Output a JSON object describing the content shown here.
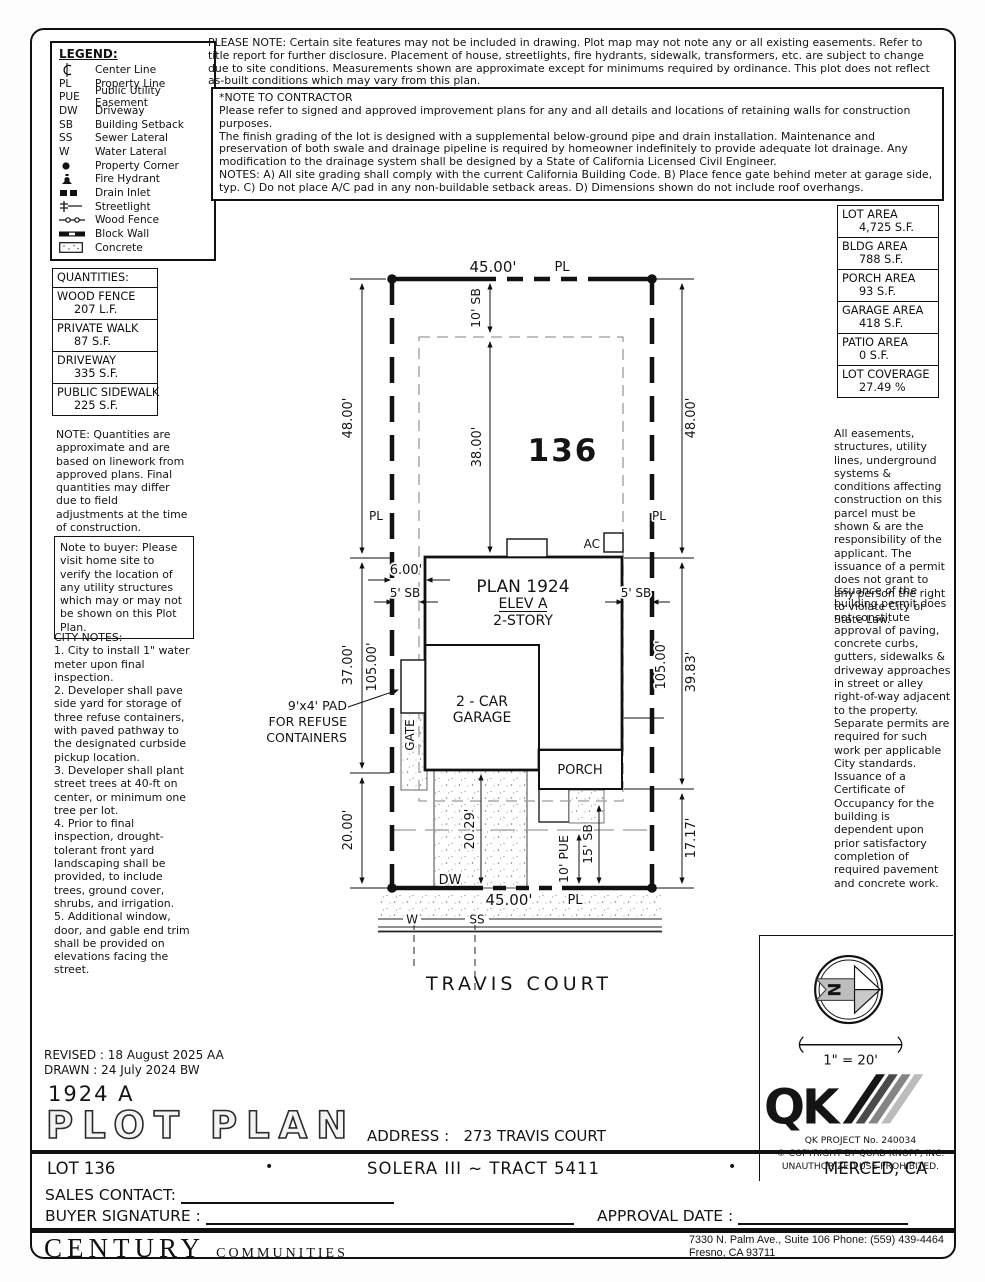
{
  "legend": {
    "title": "LEGEND:",
    "items": [
      {
        "sym": "",
        "label": "Center Line"
      },
      {
        "sym": "PL",
        "label": "Property Line"
      },
      {
        "sym": "PUE",
        "label": "Public Utility Easement"
      },
      {
        "sym": "DW",
        "label": "Driveway"
      },
      {
        "sym": "SB",
        "label": "Building Setback"
      },
      {
        "sym": "SS",
        "label": "Sewer Lateral"
      },
      {
        "sym": "W",
        "label": "Water Lateral"
      },
      {
        "sym": "",
        "label": "Property Corner"
      },
      {
        "sym": "",
        "label": "Fire Hydrant"
      },
      {
        "sym": "",
        "label": "Drain Inlet"
      },
      {
        "sym": "",
        "label": "Streetlight"
      },
      {
        "sym": "",
        "label": "Wood Fence"
      },
      {
        "sym": "",
        "label": "Block Wall"
      },
      {
        "sym": "",
        "label": "Concrete"
      }
    ]
  },
  "top_notes": {
    "please_note": "PLEASE NOTE:  Certain site features may not be included in drawing.  Plot map may not note any or all existing easements. Refer to title report for further disclosure.  Placement of house, streetlights, fire hydrants, sidewalk, transformers, etc. are subject to change due to site conditions.  Measurements shown are approximate except for minimums required by ordinance.  This plot does not reflect as-built conditions which may vary from this plan.",
    "contractor_note": "*NOTE TO CONTRACTOR\nPlease refer to signed and approved improvement plans for any and all details and locations of retaining walls for construction purposes.\nThe finish grading of the lot is designed with a supplemental below-ground pipe and drain installation.  Maintenance and preservation of both swale and drainage pipeline is required by homeowner indefinitely to provide adequate lot drainage.  Any modification to the drainage system shall be designed by a State of California Licensed Civil Engineer.\nNOTES:  A) All site grading shall comply with the current California Building Code.  B) Place fence gate behind meter at garage side, typ.  C) Do not place A/C pad in any non-buildable setback areas.  D) Dimensions shown do not include roof overhangs."
  },
  "quantities": {
    "title": "QUANTITIES:",
    "rows": [
      {
        "name": "WOOD FENCE",
        "value": "207 L.F."
      },
      {
        "name": "PRIVATE WALK",
        "value": "87 S.F."
      },
      {
        "name": "DRIVEWAY",
        "value": "335 S.F."
      },
      {
        "name": "PUBLIC SIDEWALK",
        "value": "225 S.F."
      }
    ],
    "note": "NOTE: Quantities are approximate and are based on linework from approved plans.  Final quantities may differ due to field adjustments at the time of construction."
  },
  "buyer_note": "Note to buyer: Please visit home site to verify the location of any utility structures which may or may not be shown on this Plot Plan.",
  "city_notes": "CITY NOTES:\n1. City to install 1\" water meter upon final inspection.\n2. Developer shall pave side yard for storage of three refuse containers, with paved pathway to the designated curbside pickup location.\n3. Developer shall plant street trees at 40-ft on center, or minimum one tree per lot.\n4. Prior to final inspection, drought-tolerant front yard landscaping shall be provided, to include trees, ground cover, shrubs, and irrigation.\n5. Additional window, door, and gable end trim shall be provided on elevations facing the street.",
  "areas": {
    "rows": [
      {
        "name": "LOT AREA",
        "value": "4,725 S.F."
      },
      {
        "name": "BLDG AREA",
        "value": "788 S.F."
      },
      {
        "name": "PORCH AREA",
        "value": "93 S.F."
      },
      {
        "name": "GARAGE AREA",
        "value": "418 S.F."
      },
      {
        "name": "PATIO AREA",
        "value": "0 S.F."
      },
      {
        "name": "LOT COVERAGE",
        "value": "27.49 %"
      }
    ]
  },
  "side_notes": {
    "p1": "All easements, structures, utility lines, underground systems & conditions affecting construction on this parcel must be shown & are the responsibility of the applicant. The issuance of a permit does not grant to any person the right to violate City or State Law.",
    "p2": "Issuance of the building permit does not constitute approval of paving, concrete curbs, gutters, sidewalks & driveway approaches in street or alley right-of-way adjacent to the property. Separate permits are required for such work per applicable City standards. Issuance of a Certificate of Occupancy for the building is dependent upon prior satisfactory completion of required pavement and concrete work."
  },
  "plot": {
    "labels": {
      "dim_45_top": "45.00'",
      "pl_top": "PL",
      "sb10": "10' SB",
      "dim38": "38.00'",
      "lot_number": "136",
      "dim48_left": "48.00'",
      "dim48_right": "48.00'",
      "pl_left": "PL",
      "pl_right": "PL",
      "dim6": "6.00'",
      "sb5_left": "5' SB",
      "sb5_right": "5' SB",
      "plan_name": "PLAN 1924",
      "elev": "ELEV A",
      "story": "2-STORY",
      "ac": "AC",
      "garage1": "2 - CAR",
      "garage2": "GARAGE",
      "porch": "PORCH",
      "gate": "GATE",
      "pad1": "9'x4' PAD",
      "pad2": "FOR REFUSE",
      "pad3": "CONTAINERS",
      "dim37": "37.00'",
      "dim105_left": "105.00'",
      "dim105_right": "105.00'",
      "dim3983": "39.83'",
      "dim20": "20.00'",
      "dim2029": "20.29'",
      "pue10": "10' PUE",
      "sb15": "15' SB",
      "dim1717": "17.17'",
      "dw": "DW",
      "dim_45_bottom": "45.00'",
      "pl_bottom": "PL",
      "w": "W",
      "ss": "SS",
      "street": "TRAVIS COURT"
    }
  },
  "compass": {
    "n": "N"
  },
  "scale_label": "1\" = 20'",
  "stamp": {
    "logo": "QK",
    "project": "QK PROJECT No. 240034",
    "copyright": "©  COPYRIGHT BY QUAD KNOPF, INC.",
    "prohibited": "UNAUTHORIZED USE PROHIBITED."
  },
  "titleblock": {
    "revised": "REVISED :   18 August 2025   AA",
    "drawn": "DRAWN :   24 July 2024   BW",
    "plan_code": "1924   A",
    "sheet_title": "PLOT PLAN",
    "address_label": "ADDRESS :",
    "address": "273 TRAVIS COURT",
    "lot": "LOT 136",
    "bullet": "•",
    "tract": "SOLERA III ~ TRACT 5411",
    "city": "MERCED, CA",
    "sales_label": "SALES CONTACT:",
    "buyer_label": "BUYER SIGNATURE :",
    "approval_label": "APPROVAL DATE :"
  },
  "builder": {
    "name": "CENTURY",
    "suffix": "COMMUNITIES",
    "address_line1": "7330 N. Palm Ave., Suite 106     Phone:  (559) 439-4464",
    "address_line2": "Fresno, CA  93711"
  }
}
